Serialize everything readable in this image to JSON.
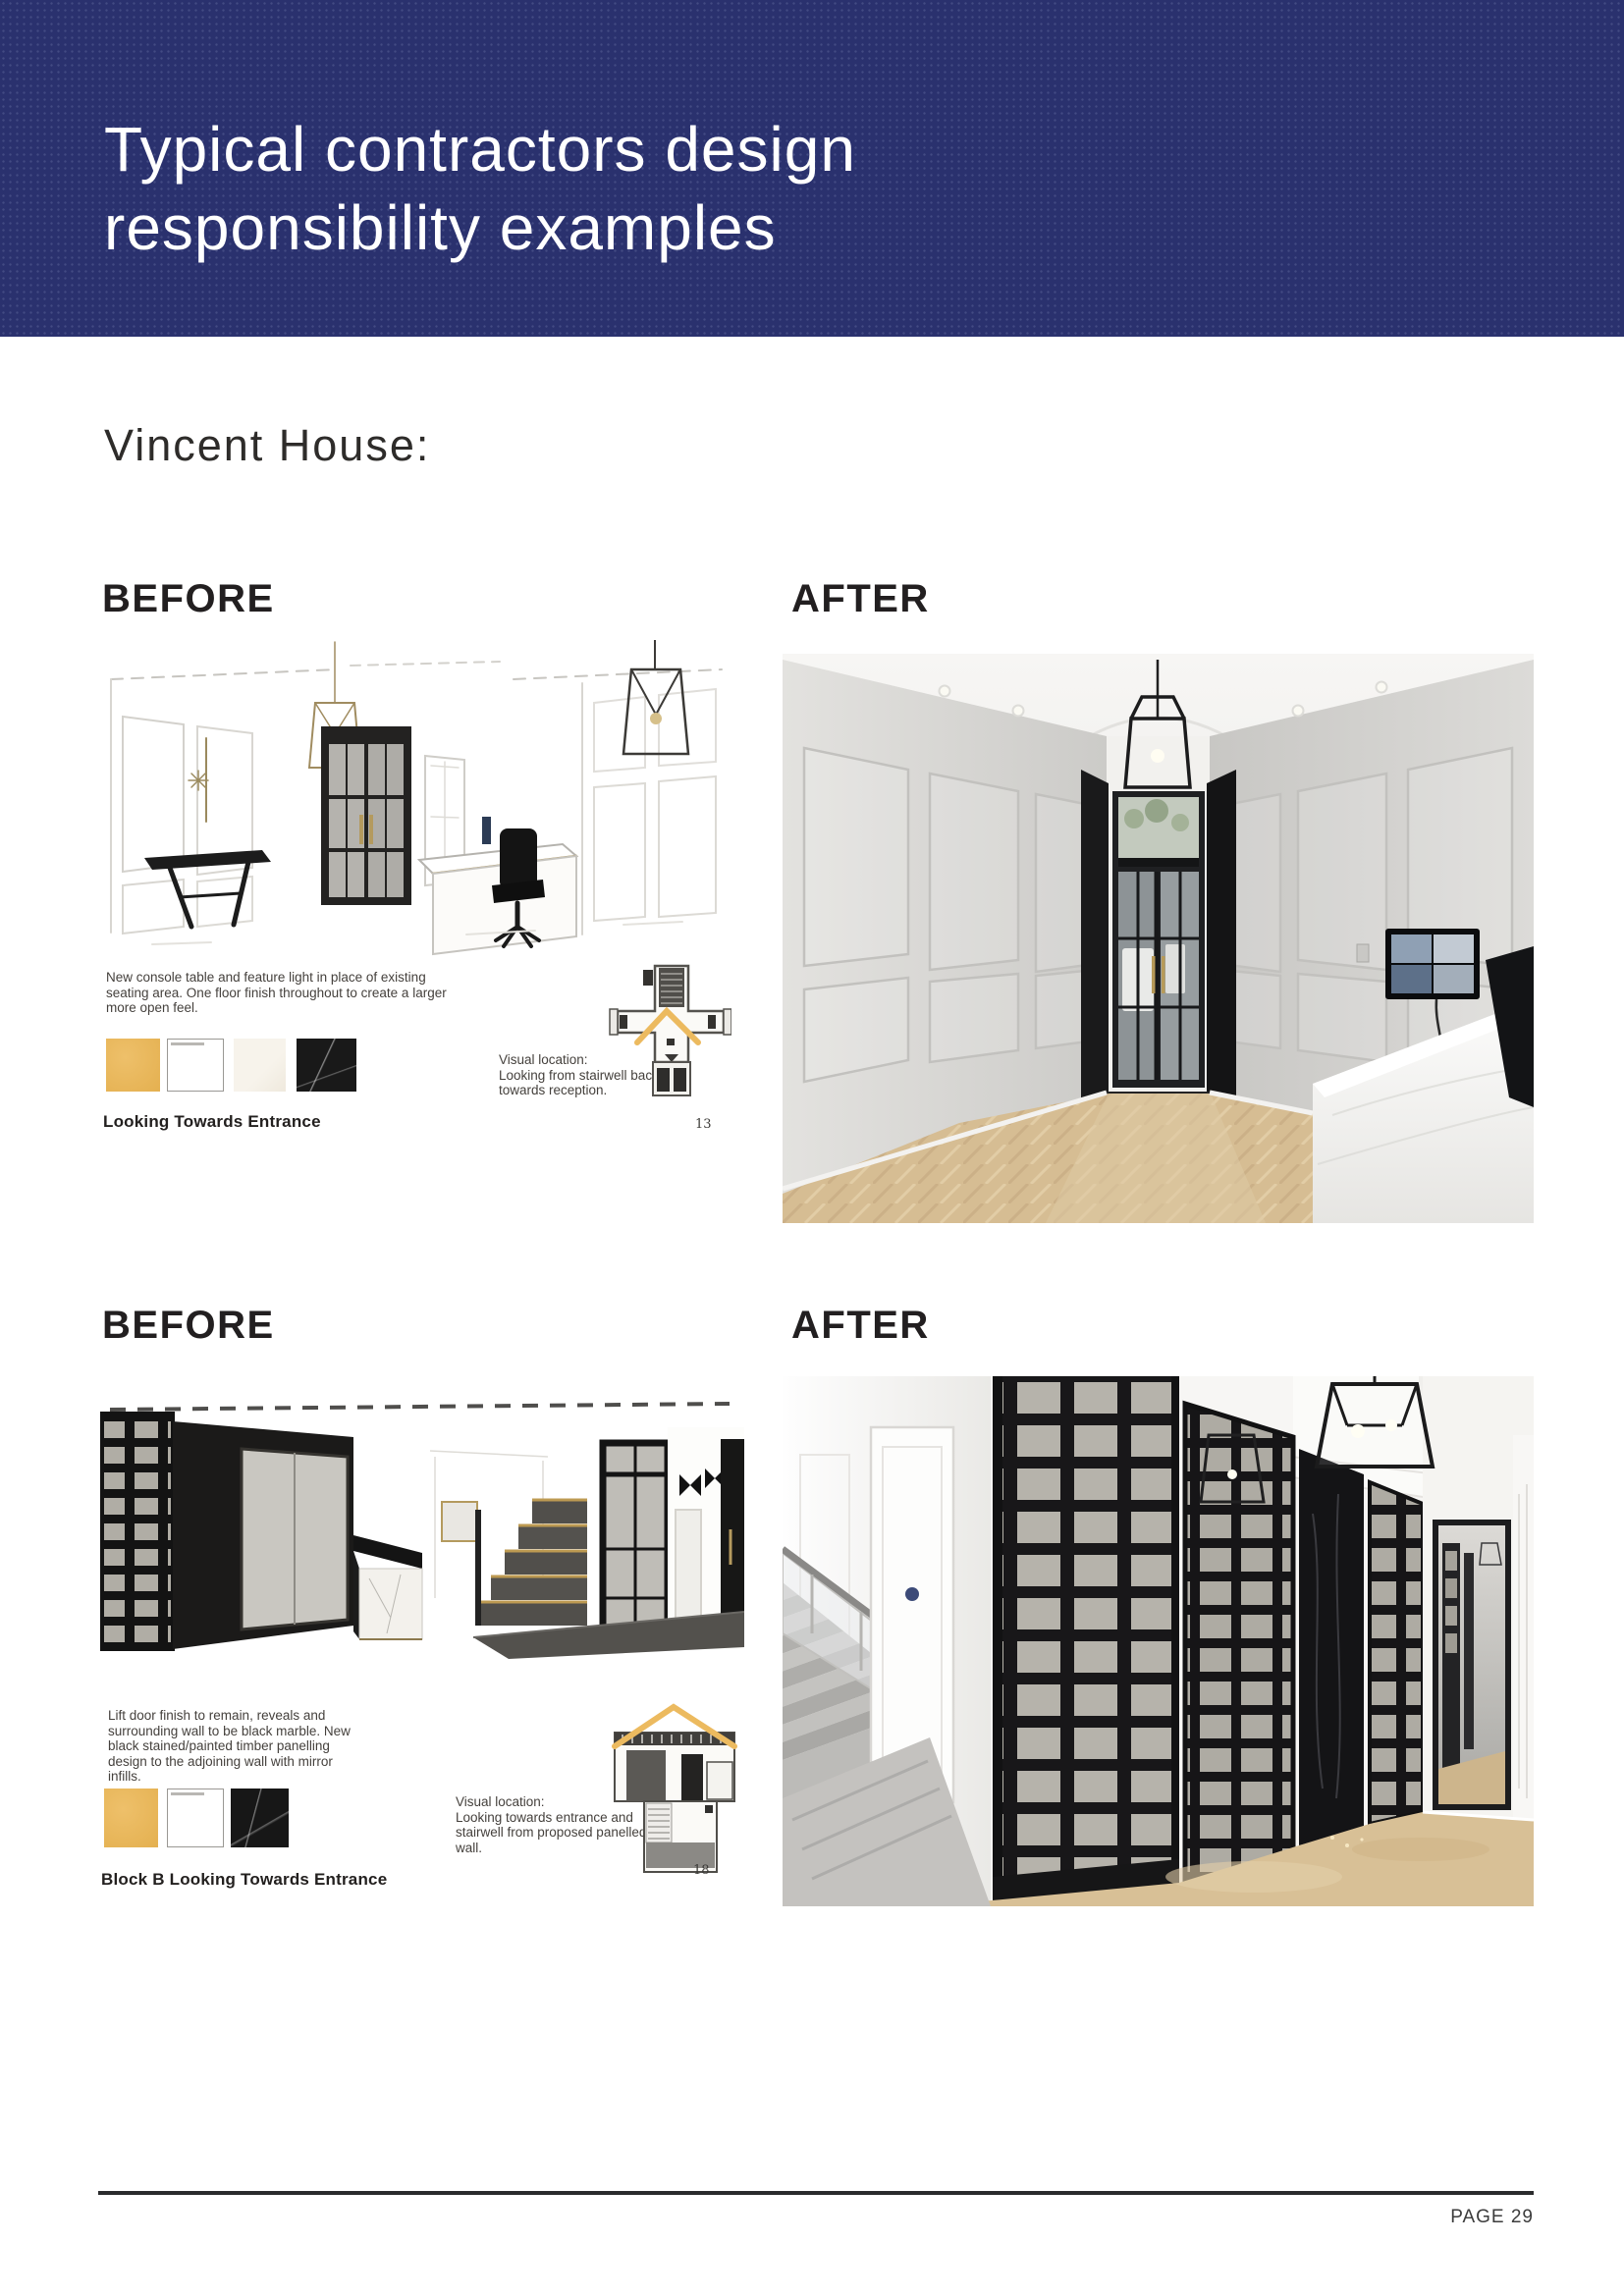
{
  "banner": {
    "title_line1": "Typical contractors design",
    "title_line2": "responsibility examples",
    "bg_color": "#2a316e",
    "text_color": "#ffffff"
  },
  "heading": "Vincent House:",
  "comparisons": [
    {
      "before_label": "BEFORE",
      "after_label": "AFTER",
      "caption": "New console table and feature light in place of existing seating area. One floor finish throughout to create a larger more open feel.",
      "view_label": "Looking Towards Entrance",
      "visual_location_title": "Visual location:",
      "visual_location_body": "Looking from stairwell back towards reception.",
      "source_page_number": "13",
      "swatches": [
        {
          "name": "gold-fabric",
          "hex": "#e9b95c"
        },
        {
          "name": "white-panel",
          "hex": "#ffffff"
        },
        {
          "name": "light-marble",
          "hex": "#f5f1e8"
        },
        {
          "name": "black-marble",
          "hex": "#1a1a1a"
        }
      ]
    },
    {
      "before_label": "BEFORE",
      "after_label": "AFTER",
      "caption": "Lift door finish to remain, reveals and surrounding wall to be black marble. New black stained/painted timber panelling design to the adjoining wall with mirror infills.",
      "view_label": "Block B Looking Towards Entrance",
      "visual_location_title": "Visual location:",
      "visual_location_body": "Looking towards entrance and stairwell from proposed panelled wall.",
      "source_page_number": "18",
      "swatches": [
        {
          "name": "gold-fabric",
          "hex": "#e9b95c"
        },
        {
          "name": "white-panel",
          "hex": "#ffffff"
        },
        {
          "name": "black-marble",
          "hex": "#1a1a1a"
        }
      ]
    }
  ],
  "accent_colors": {
    "plan_marker_gold": "#ecba5f",
    "timber_gold": "#b49a5e",
    "footer_rule": "#2a2b2d"
  },
  "footer": {
    "page_label": "PAGE 29"
  }
}
